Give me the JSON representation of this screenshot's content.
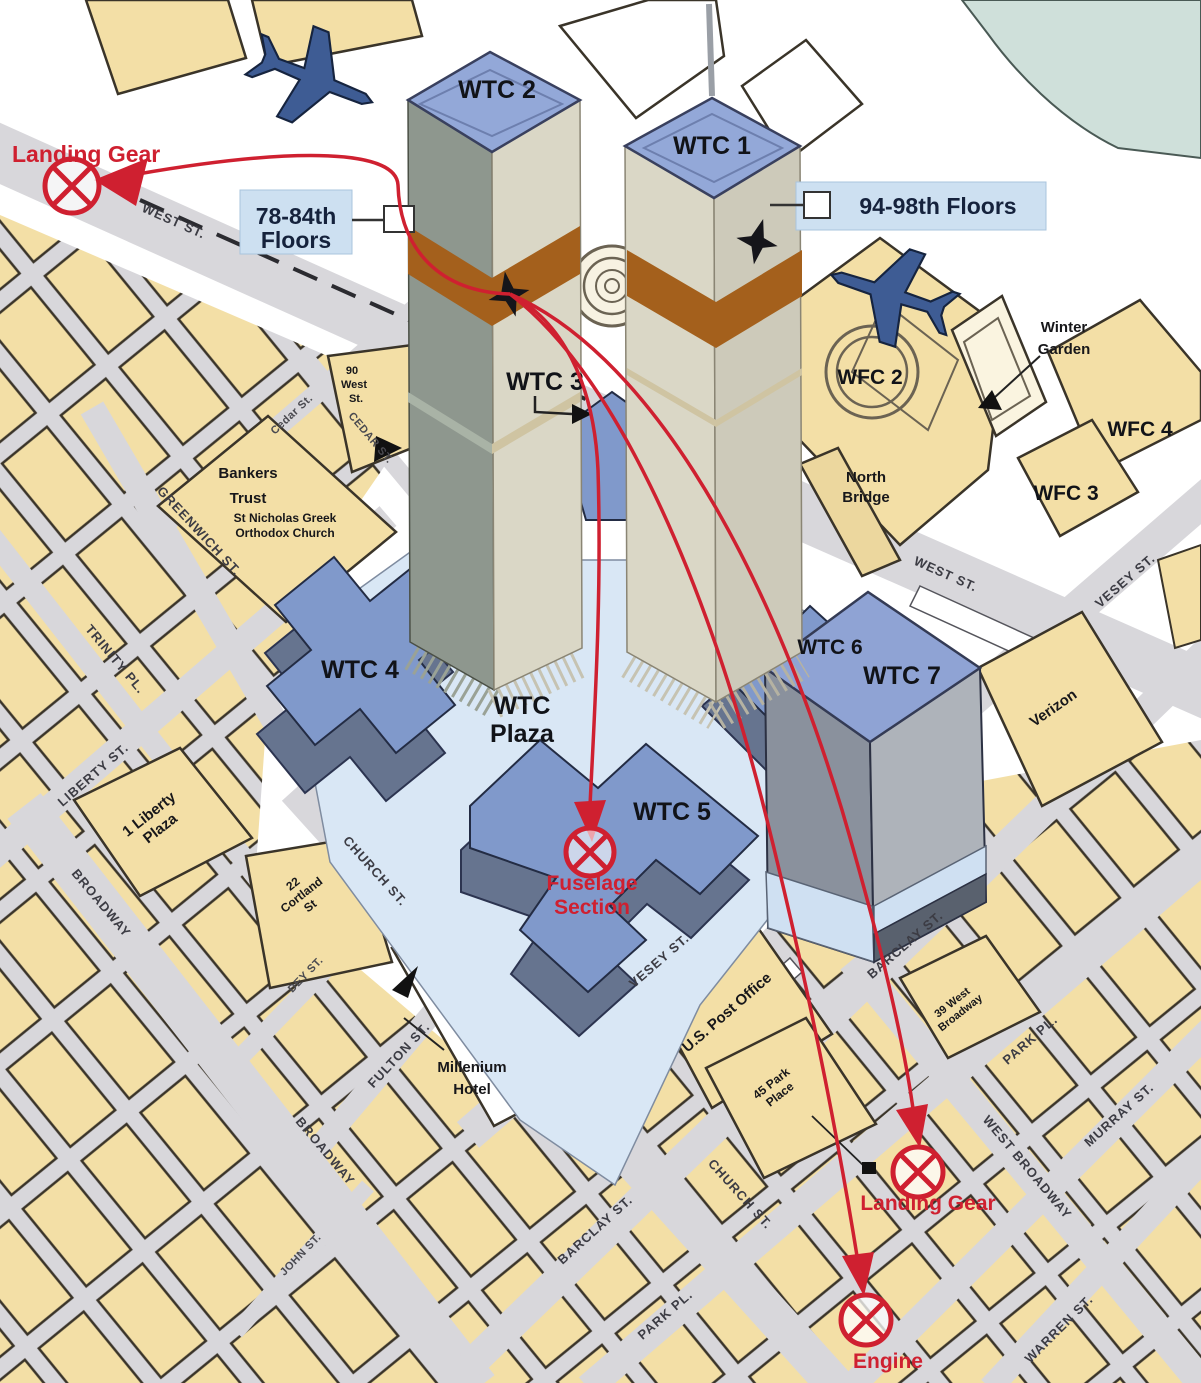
{
  "annotations": {
    "landing_gear_sw": "Landing Gear",
    "impact_wtc2_floors": [
      "78-84th",
      "Floors"
    ],
    "impact_wtc1_floors": "94-98th Floors",
    "wtc3_callout": "WTC 3",
    "fuselage_section": [
      "Fuselage",
      "Section"
    ],
    "landing_gear_ne": "Landing Gear",
    "engine": "Engine"
  },
  "buildings": {
    "wtc1": "WTC 1",
    "wtc2": "WTC 2",
    "wtc4": "WTC 4",
    "wtc5": "WTC 5",
    "wtc6": "WTC 6",
    "wtc7": "WTC 7",
    "wtc_plaza": [
      "WTC",
      "Plaza"
    ],
    "wfc2": "WFC 2",
    "wfc3": "WFC 3",
    "wfc4": "WFC 4",
    "winter_garden": [
      "Winter",
      "Garden"
    ],
    "north_bridge": [
      "North",
      "Bridge"
    ],
    "bankers_trust": [
      "Bankers",
      "Trust"
    ],
    "st_nicholas": [
      "St Nicholas Greek",
      "Orthodox Church"
    ],
    "ninety_west": [
      "90",
      "West",
      "St."
    ],
    "one_liberty": [
      "1 Liberty",
      "Plaza"
    ],
    "cortland_22": [
      "22",
      "Cortland",
      "St"
    ],
    "millenium_hotel": [
      "Millenium",
      "Hotel"
    ],
    "us_post_office": "U.S. Post Office",
    "park_place_45": [
      "45 Park",
      "Place"
    ],
    "verizon": "Verizon",
    "west_broadway_39": [
      "39 West",
      "Broadway"
    ]
  },
  "streets": {
    "west_st": "WEST ST.",
    "west_st_2": "WEST ST.",
    "vesey_st": "VESEY ST.",
    "vesey_st_2": "VESEY ST.",
    "church_st": "CHURCH ST.",
    "church_st_2": "CHURCH ST.",
    "broadway": "BROADWAY",
    "broadway_2": "BROADWAY",
    "liberty_st": "LIBERTY ST.",
    "trinity_pl": "TRINITY PL.",
    "greenwich_st": "GREENWICH ST.",
    "cedar_st": "Cedar St.",
    "cedar_st_2": "CEDAR ST.",
    "dey_st": "DEY ST.",
    "fulton_st": "FULTON ST.",
    "john_st": "JOHN ST.",
    "barclay_st": "BARCLAY ST.",
    "barclay_st_2": "BARCLAY ST.",
    "park_pl": "PARK PL.",
    "park_pl_2": "PARK PL.",
    "murray_st": "MURRAY ST.",
    "warren_st": "WARREN ST.",
    "west_broadway": "WEST BROADWAY"
  },
  "colors": {
    "block_fill": "#f3dfa6",
    "street_fill": "#d8d7db",
    "plaza_fill": "#d9e7f5",
    "wtc_blue": "#8099cb",
    "tower_face_light": "#dad7c6",
    "tower_face_dark": "#8e978e",
    "impact_band": "#a4601c",
    "trajectory_red": "#cf2030",
    "plane_blue": "#3e5c94",
    "water_teal": "#cfe0da",
    "label_box_blue": "#cde0f1"
  }
}
